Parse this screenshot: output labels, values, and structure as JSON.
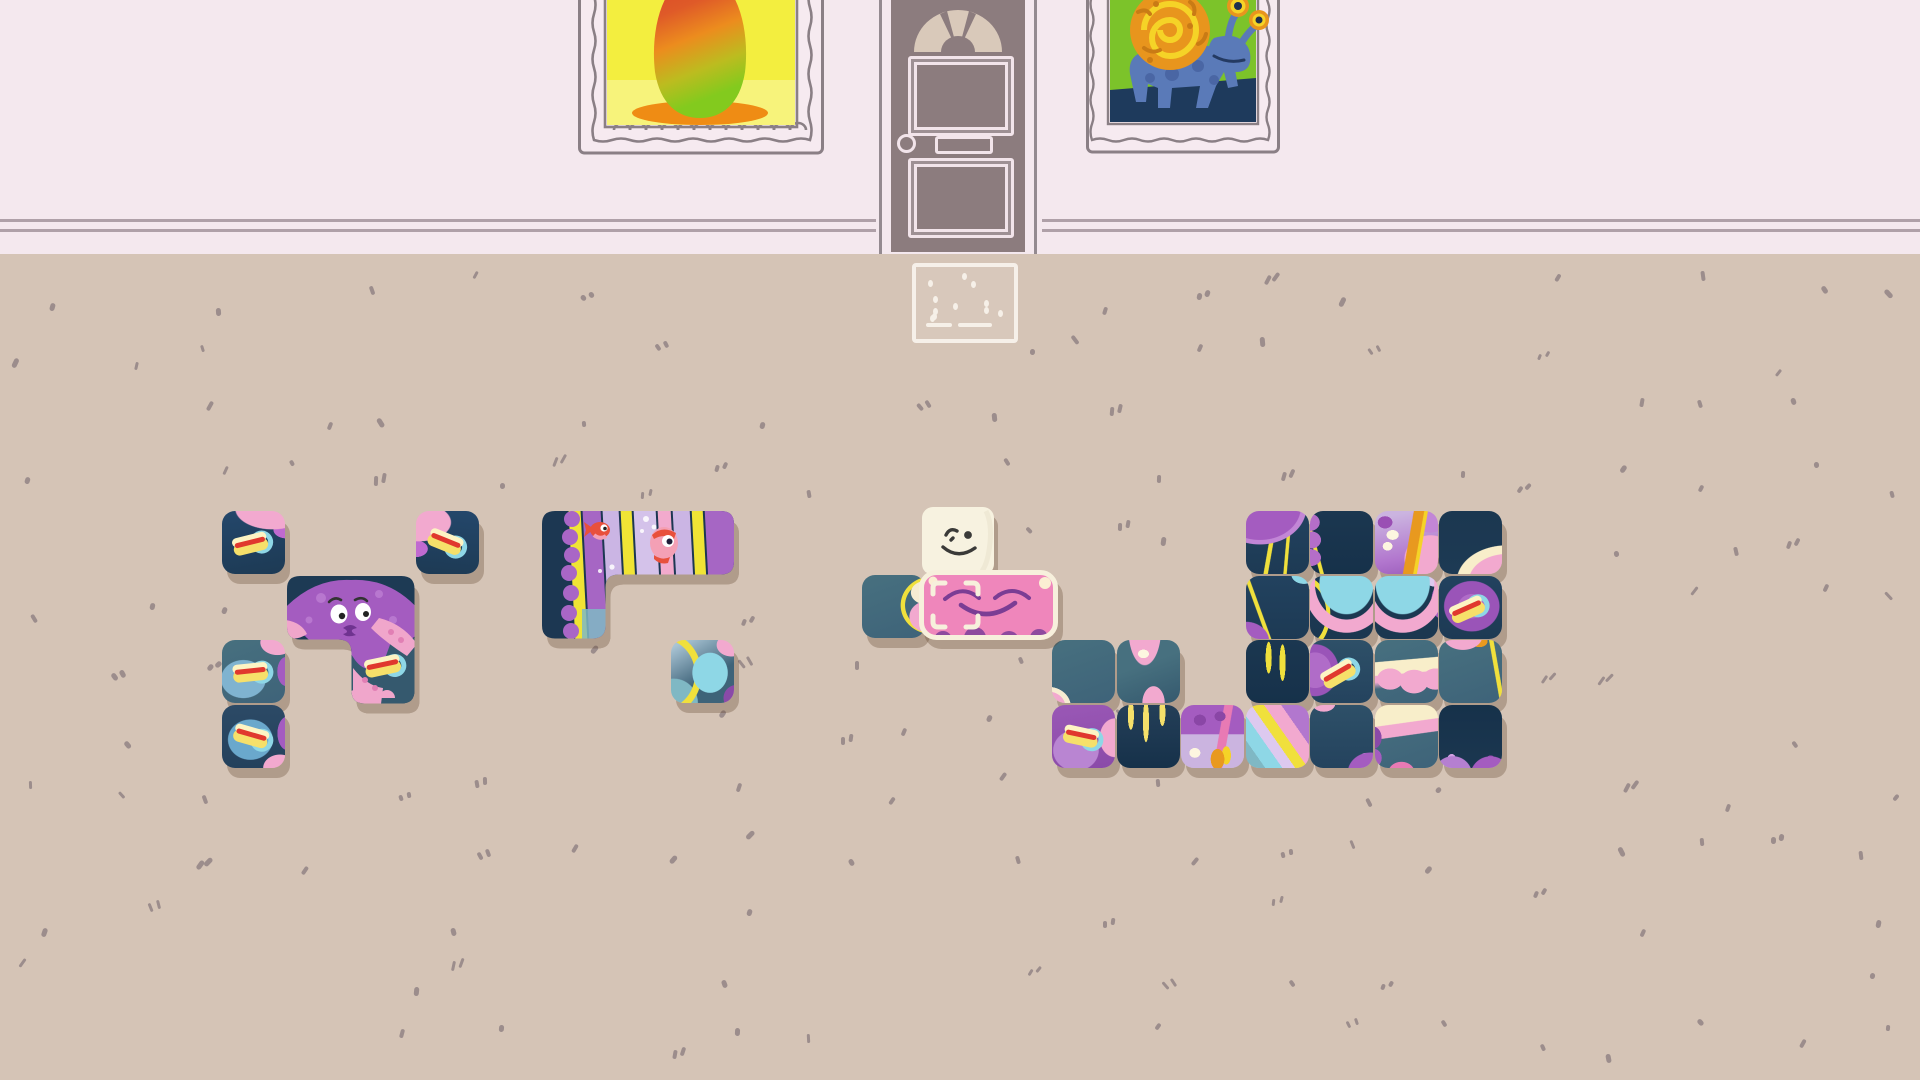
{
  "scene": {
    "name": "puzzle-room",
    "wall": {
      "color": "#f4e8ee",
      "trim_color": "#a2939b",
      "trim_y": [
        219,
        229
      ],
      "floor_start_y": 254
    },
    "floor": {
      "color": "#d5c4b6",
      "speckle_color": "#8d8082",
      "shadow_color": "rgba(92,62,40,0.30)"
    }
  },
  "palette": {
    "navy": "#1d3a54",
    "navy2": "#16314a",
    "slate": "#3e6379",
    "slate2": "#2e5068",
    "purple": "#a45cc0",
    "purple_dark": "#8a4aa8",
    "lavender": "#cbb4e0",
    "lavender_light": "#ddc9ef",
    "pink": "#f2a9cf",
    "pink_deep": "#e87ab4",
    "cream": "#f8eeca",
    "yellow": "#f0e03c",
    "gold": "#e8991f",
    "red": "#e0382e",
    "cyan": "#8ed7e6",
    "teal": "#7fb8c4",
    "door": "#8c7c7e",
    "door_glass": "#d9c9ba",
    "frame": "#8a7f85",
    "panel_line": "#f2e4ea",
    "character": "#f7f2e0",
    "held_piece_pink": "#ef86bb"
  },
  "door": {
    "x": 876,
    "width": 166,
    "height": 254,
    "fanlight": "arched-fan-window",
    "panels": 2,
    "knob": "left",
    "letter_slot": true
  },
  "pictures": [
    {
      "id": "mango-painting",
      "x": 578,
      "y": -20,
      "width": 246,
      "height": 175,
      "subject": "red-green mango on yellow background",
      "bg": "#f3ee3f"
    },
    {
      "id": "snail-creature-painting",
      "x": 1086,
      "y": -18,
      "width": 194,
      "height": 175,
      "subject": "blue dog-like creature with orange snail shell and eye stalks on green background",
      "bg": "#7cc32a"
    }
  ],
  "doormat": {
    "x": 912,
    "y": 263,
    "width": 98,
    "height": 72
  },
  "character": {
    "id": "wilmot",
    "x": 920,
    "y": 505,
    "width": 76,
    "height": 72,
    "expression": "smiling-wink"
  },
  "held_piece": {
    "id": "pink-sleeping-piece",
    "x": 919,
    "y": 570,
    "width": 139,
    "height": 70,
    "cells": 2,
    "selected": true,
    "face": "closed-eyes-smile"
  },
  "board": {
    "tile_size": 63,
    "pitch": 64.5,
    "groups": [
      {
        "name": "octopus-hotdog-puzzle",
        "origin": [
          222,
          511
        ],
        "pieces": [
          {
            "cells": [
              [
                0,
                0
              ]
            ],
            "art": "hotdog_navy_a",
            "hotdog": -14
          },
          {
            "cells": [
              [
                3,
                0
              ]
            ],
            "art": "hotdog_navy_b",
            "hotdog": 22
          },
          {
            "cells": [
              [
                1,
                1
              ],
              [
                2,
                1
              ],
              [
                2,
                2
              ]
            ],
            "svg": "octopus",
            "art": "octopus-head-with-hotdog"
          },
          {
            "cells": [
              [
                0,
                2
              ]
            ],
            "art": "hotdog_teal",
            "hotdog": -6
          },
          {
            "cells": [
              [
                0,
                3
              ]
            ],
            "art": "hotdog_navy_c",
            "hotdog": 16
          }
        ]
      },
      {
        "name": "anemone-stripes-puzzle",
        "origin": [
          542,
          511
        ],
        "pieces": [
          {
            "cells": [
              [
                0,
                0
              ],
              [
                1,
                0
              ],
              [
                2,
                0
              ],
              [
                0,
                1
              ]
            ],
            "svg": "stripes",
            "art": "striped-anemone-with-fish"
          },
          {
            "cells": [
              [
                2,
                2
              ]
            ],
            "art": "cyan_fish"
          }
        ]
      },
      {
        "name": "held-area",
        "origin": [
          862,
          575
        ],
        "pieces": [
          {
            "cells": [
              [
                0,
                0
              ]
            ],
            "art": "teal_blob"
          }
        ]
      },
      {
        "name": "jellyfish-puzzle",
        "origin": [
          1052,
          511
        ],
        "pieces": [
          {
            "cells": [
              [
                3,
                0
              ]
            ],
            "art": "jelly_fringe_nw"
          },
          {
            "cells": [
              [
                4,
                0
              ]
            ],
            "art": "navy_fringe_w"
          },
          {
            "cells": [
              [
                5,
                0
              ]
            ],
            "art": "jelly_head_top"
          },
          {
            "cells": [
              [
                6,
                0
              ]
            ],
            "art": "navy_wave_se"
          },
          {
            "cells": [
              [
                3,
                1
              ]
            ],
            "art": "navy_blob_sw"
          },
          {
            "cells": [
              [
                4,
                1
              ]
            ],
            "art": "cyan_jelly_l"
          },
          {
            "cells": [
              [
                5,
                1
              ]
            ],
            "art": "cyan_jelly_r"
          },
          {
            "cells": [
              [
                6,
                1
              ]
            ],
            "art": "donut_hotdog",
            "hotdog": -24
          },
          {
            "cells": [
              [
                0,
                2
              ]
            ],
            "art": "teal_corner_blob"
          },
          {
            "cells": [
              [
                1,
                2
              ]
            ],
            "art": "teal_tentacle"
          },
          {
            "cells": [
              [
                3,
                2
              ]
            ],
            "art": "navy_tentacles"
          },
          {
            "cells": [
              [
                4,
                2
              ]
            ],
            "art": "tentacle_hotdog",
            "hotdog": -30
          },
          {
            "cells": [
              [
                5,
                2
              ]
            ],
            "art": "bell_edge"
          },
          {
            "cells": [
              [
                6,
                2
              ]
            ],
            "art": "slate_blob_ne"
          },
          {
            "cells": [
              [
                0,
                3
              ]
            ],
            "art": "purple_hotdog",
            "hotdog": 12
          },
          {
            "cells": [
              [
                1,
                3
              ]
            ],
            "art": "navy_drips"
          },
          {
            "cells": [
              [
                2,
                3
              ]
            ],
            "art": "anemone_dome"
          },
          {
            "cells": [
              [
                3,
                3
              ]
            ],
            "art": "diag_stripes"
          },
          {
            "cells": [
              [
                4,
                3
              ]
            ],
            "art": "navy_dome_se"
          },
          {
            "cells": [
              [
                5,
                3
              ]
            ],
            "art": "bell_interior"
          },
          {
            "cells": [
              [
                6,
                3
              ]
            ],
            "art": "navy_domes_s"
          }
        ]
      }
    ]
  }
}
